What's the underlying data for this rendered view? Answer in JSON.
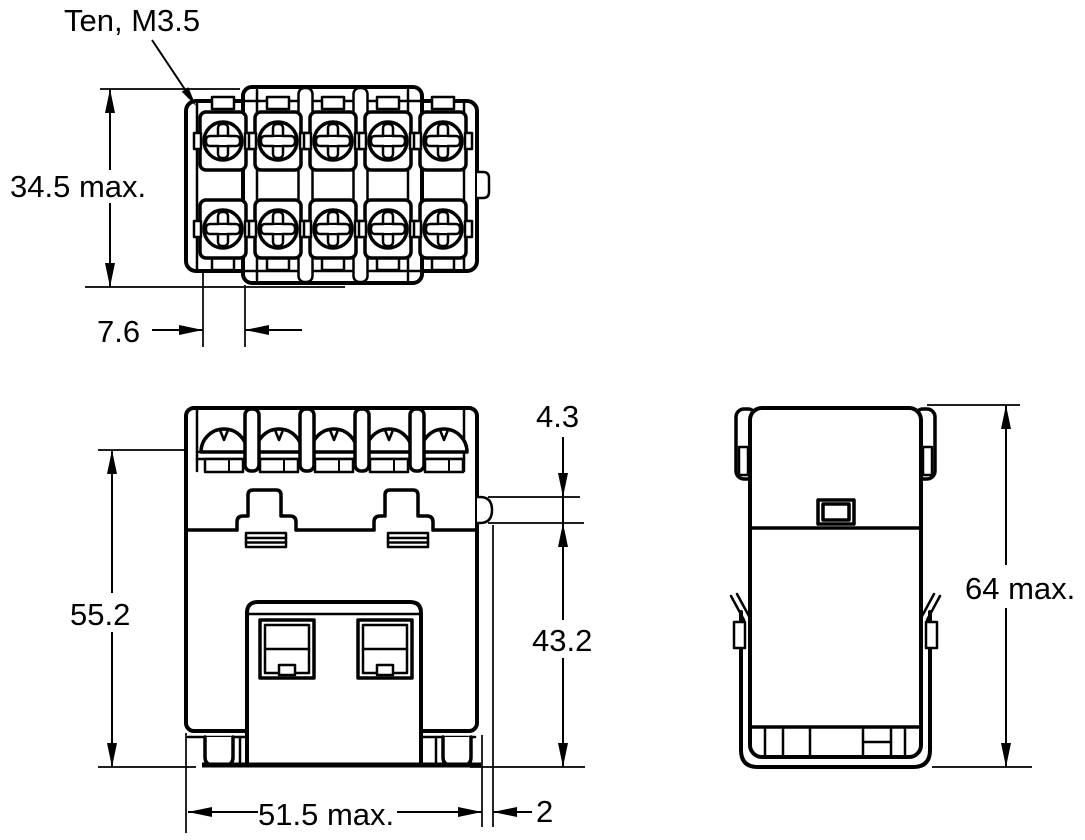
{
  "labels": {
    "terminal_screws": "Ten, M3.5",
    "top_height": "34.5 max.",
    "terminal_pitch": "7.6",
    "front_height": "55.2",
    "bump_height": "4.3",
    "lower_height": "43.2",
    "width": "51.5 max.",
    "bump_depth": "2",
    "overall_height": "64 max."
  },
  "colors": {
    "line": "#000000",
    "background": "#ffffff"
  }
}
